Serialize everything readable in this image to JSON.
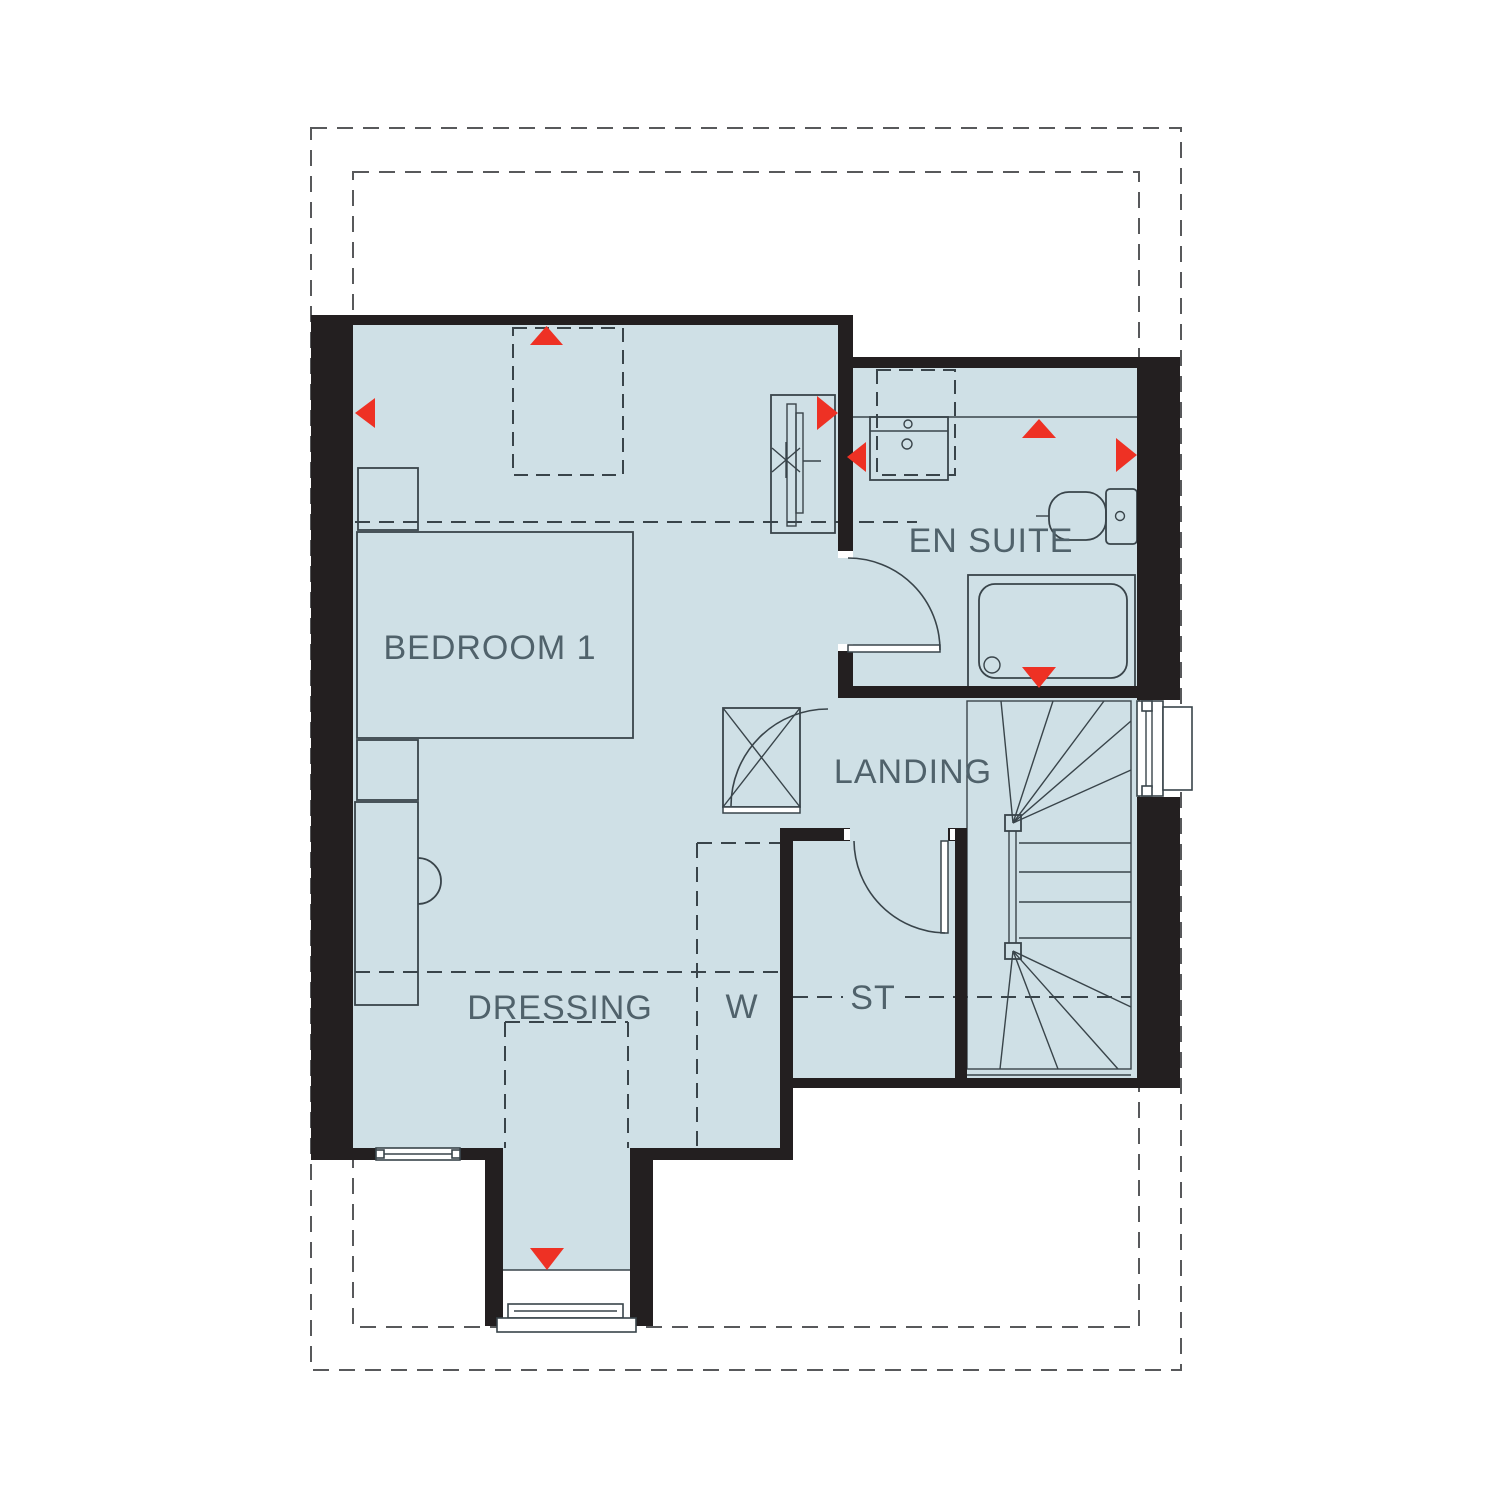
{
  "rooms": {
    "bedroom1": "BEDROOM 1",
    "ensuite": "EN SUITE",
    "landing": "LANDING",
    "dressing": "DRESSING",
    "wardrobe": "W",
    "store": "ST"
  },
  "colors": {
    "floor": "#cfe0e6",
    "wall": "#231f20",
    "line": "#39444a",
    "dashed_outline": "#58595b",
    "label_text": "#50626b",
    "marker_red": "#ee3124",
    "background": "#ffffff"
  },
  "markers": [
    {
      "icon": "window-marker-icon",
      "room": "bedroom1",
      "direction": "up"
    },
    {
      "icon": "window-marker-icon",
      "room": "bedroom1",
      "direction": "left"
    },
    {
      "icon": "window-marker-icon",
      "room": "bedroom1",
      "direction": "right"
    },
    {
      "icon": "window-marker-icon",
      "room": "ensuite",
      "direction": "left"
    },
    {
      "icon": "window-marker-icon",
      "room": "ensuite",
      "direction": "up"
    },
    {
      "icon": "window-marker-icon",
      "room": "ensuite",
      "direction": "right"
    },
    {
      "icon": "window-marker-icon",
      "room": "ensuite-shower",
      "direction": "down"
    },
    {
      "icon": "window-marker-icon",
      "room": "dressing-bay",
      "direction": "down"
    }
  ]
}
